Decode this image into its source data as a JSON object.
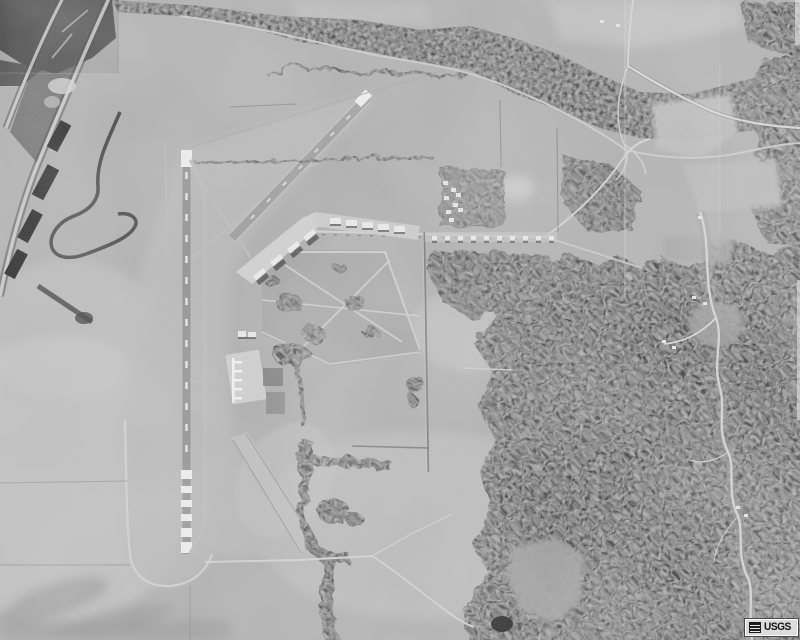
{
  "photo": {
    "kind": "grayscale USGS aerial orthophoto",
    "scene": "airfield with long north-south runway and diagonal runway, base street grid and aprons, farm fields, wooded river corridor along the top, highway at left, dense forest on the right with a winding road"
  },
  "watermark": {
    "label": "USGS"
  },
  "palette": {
    "field": "#b2b2b2",
    "field_light": "#c9c9c9",
    "field_dark": "#989898",
    "grass": "#bcbcbc",
    "forest": "#414141",
    "forest_dark": "#2d2d2d",
    "river": "#484848",
    "runway_dark": "#969696",
    "runway_light": "#c2c2c2",
    "marking": "#f4f4f4",
    "road_light": "#d6d6d6",
    "road_dark": "#565656",
    "building": "#efefef",
    "pond": "#1f1f1f",
    "wm_bg": "#dcdcdc",
    "wm_text": "#111111"
  }
}
